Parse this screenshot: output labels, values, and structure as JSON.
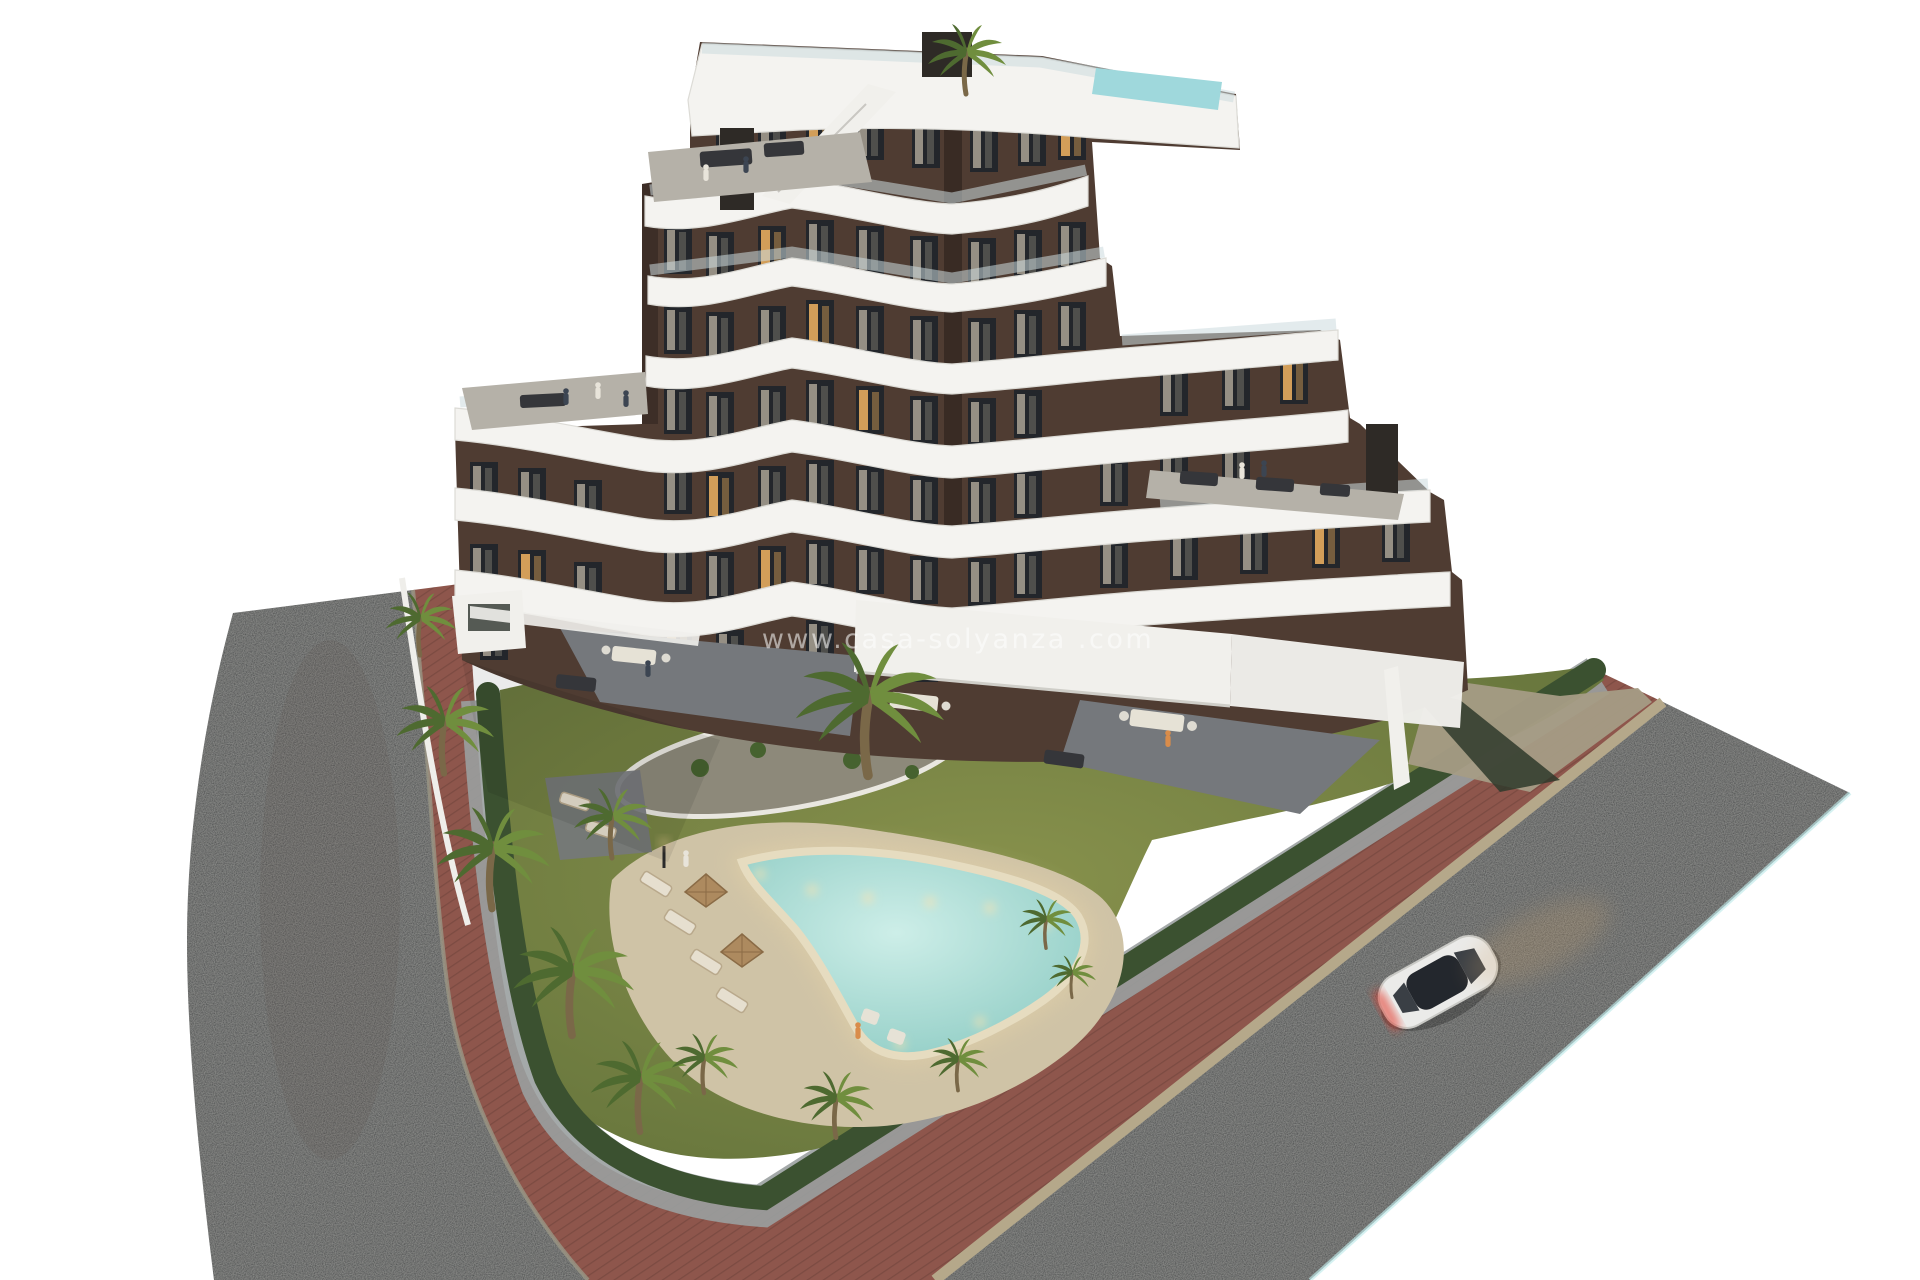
{
  "watermark": {
    "text": "www.casa-solyanza .com"
  },
  "palette": {
    "background": "#ffffff",
    "asphalt": "#3b3d40",
    "asphalt_edge": "#bfe9ea",
    "brick": "#8e564c",
    "curb": "#b5a88a",
    "gravel": "#9aa0a0",
    "hedge": "#3b5130",
    "lawn": "#6f7d41",
    "pool_deck": "#cfc3a6",
    "pool_light": "#cdeee8",
    "pool_deep": "#8fccc4",
    "pool_rim": "#e6dcc0",
    "island": "#8d897a",
    "band_white": "#f4f3f0",
    "facade": "#4f3c32",
    "facade_shadow": "#382b23",
    "window_dark": "#23262b",
    "window_warm": "#dca45c",
    "roof_pool": "#9fd8dc",
    "chimney": "#2e2a26",
    "umbrella": "#ad8a5f",
    "driveway": "#a59c85",
    "car_body": "#ebebe9",
    "car_glass": "#23272d",
    "taillight": "#e2372a",
    "headlight_glow": "#c9a06b",
    "watermark_color": "#ffffff"
  }
}
